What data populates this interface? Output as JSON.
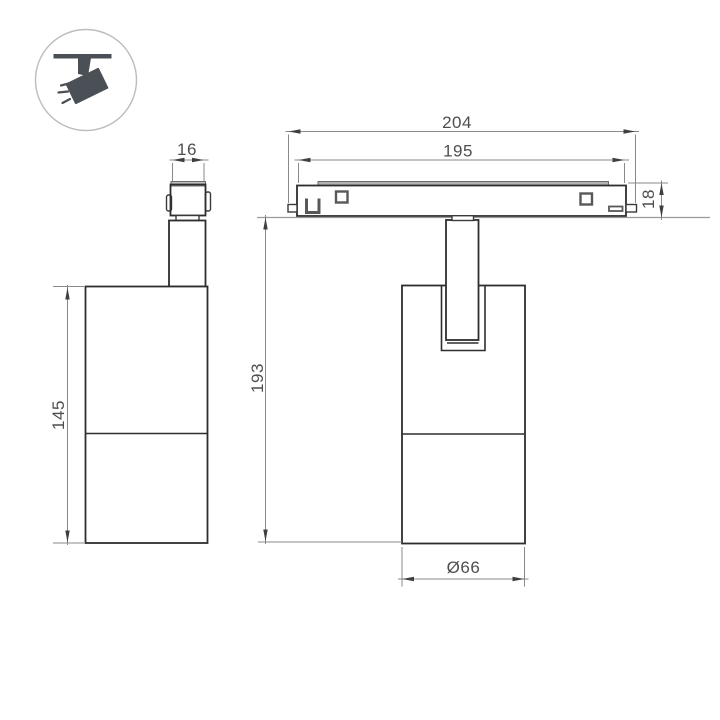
{
  "icons": {
    "track_light": "ceiling-track-spotlight-icon"
  },
  "dimensions": {
    "adapter_width": "16",
    "body_height": "145",
    "track_length": "204",
    "track_mount_length": "195",
    "track_height": "18",
    "overall_height": "193",
    "body_diameter": "Ø66"
  },
  "colors": {
    "background": "#ffffff",
    "object_line": "#2e2e2e",
    "dimension_line": "#8a8a8a",
    "dimension_text": "#4e4e4e",
    "hardware_line": "#585858",
    "track_strip": "#b3b3b3",
    "icon_glyph": "#4a5056",
    "icon_ring": "#bdbdbd"
  }
}
